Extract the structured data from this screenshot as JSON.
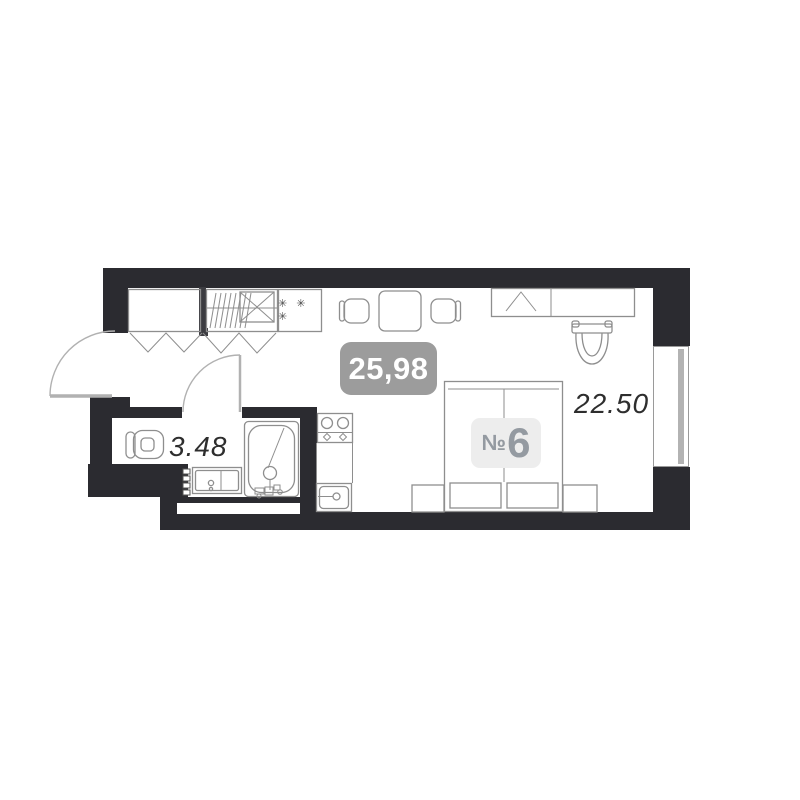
{
  "plan": {
    "unit_prefix": "№",
    "unit_number": "6",
    "total_area": "25,98",
    "room_area": "22.50",
    "bathroom_area": "3.48",
    "closet_marker": "✳ ✳ ✳"
  },
  "colors": {
    "wall": "#2b2b30",
    "outline": "#8e8e8e",
    "door": "#b1b1b1",
    "divider": "#3c3c41",
    "total_badge_bg": "#9c9c9c",
    "total_badge_text": "#ffffff",
    "unit_badge_bg": "#ededed",
    "unit_badge_text": "#949aa1",
    "area_text": "#2e2e2e",
    "marker_text": "#4a4a4a",
    "window_stripe": "#b3b3b3"
  }
}
